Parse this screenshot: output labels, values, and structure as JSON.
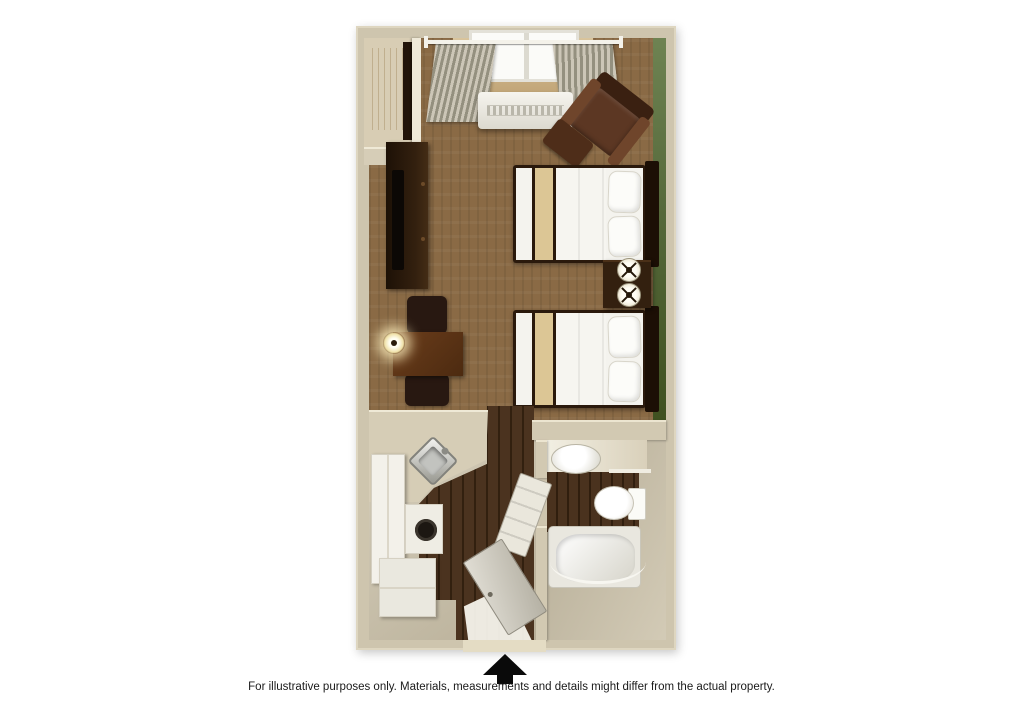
{
  "caption": "For illustrative purposes only.  Materials, measurements and details might differ from the actual property.",
  "floorplan": {
    "type": "3d-rendered studio suite floor plan, top-down view",
    "rooms": [
      {
        "name": "main living and sleeping area",
        "floor": "brown carpet"
      },
      {
        "name": "kitchenette",
        "floor": "dark wood and tile"
      },
      {
        "name": "bathroom",
        "floor": "dark wood"
      },
      {
        "name": "closet",
        "floor": "light wood"
      }
    ],
    "furniture": [
      "window with curtains and rod",
      "wall air-conditioning unit",
      "brown armchair with ottoman",
      "dresser with television",
      "desk with lamp and two chairs",
      "double bed 1",
      "double bed 2",
      "nightstand with two lamps",
      "corner kitchen sink",
      "refrigerator",
      "stove with burner",
      "base cabinet",
      "bathroom sink",
      "toilet",
      "bathtub with curved shower rod",
      "entry door (open)",
      "bathroom door (open)"
    ],
    "entrance_arrow": "black up-arrow marking the entry door at bottom center",
    "palette": {
      "background": "#ffffff",
      "walls": "#cec5ae",
      "wall_highlight": "#ece5d0",
      "carpet": "#8a6a45",
      "wood_floor": "#3f2a18",
      "accent_wall_green": "#55683a",
      "closet_wood": "#d9bb7e",
      "bedding_white": "#f4f3ee",
      "bed_runner_tan": "#dcc695",
      "dark_furniture": "#2b1a0c",
      "armchair_brown": "#5c3723",
      "fixture_white": "#f1efe8",
      "arrow": "#0a0a0a",
      "caption_text": "#1a1a1a"
    }
  }
}
